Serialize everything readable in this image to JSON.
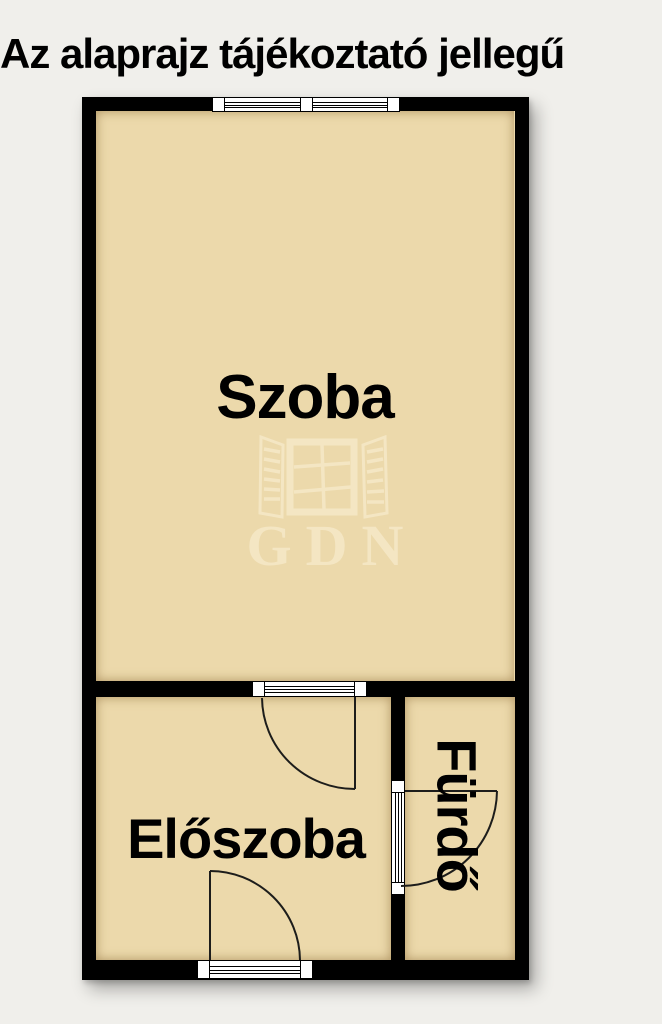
{
  "page": {
    "background_color": "#f0efeb",
    "title": "Az alaprajz tájékoztató jellegű"
  },
  "floorplan": {
    "colors": {
      "wall": "#000000",
      "room_fill": "#ecd9ab",
      "door_line": "#1d1d1b",
      "watermark": "#f4e6c3",
      "symbol_fill": "#ffffff"
    },
    "rooms": [
      {
        "id": "szoba",
        "label": "Szoba"
      },
      {
        "id": "eloszoba",
        "label": "Előszoba"
      },
      {
        "id": "furdo",
        "label": "Fürdő"
      }
    ],
    "symbols": {
      "window_top_wall": "double-window-icon",
      "door_szoba_eloszoba": "glazed-door-with-swing-icon",
      "door_entry_bottom_wall": "door-with-swing-icon",
      "door_furdo": "door-with-swing-icon"
    },
    "watermark": {
      "icon": "open-window-icon",
      "text": "GDN"
    }
  }
}
